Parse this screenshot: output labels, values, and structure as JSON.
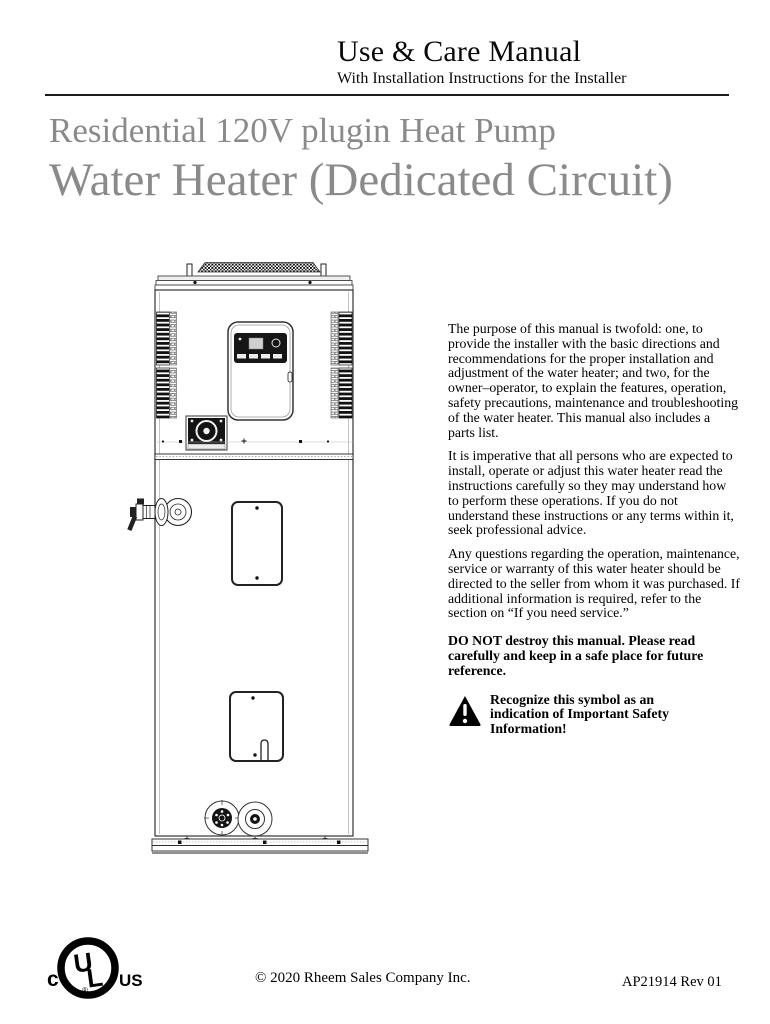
{
  "header": {
    "title": "Use & Care Manual",
    "subtitle": "With Installation Instructions for the Installer"
  },
  "title": {
    "line1": "Residential 120V plugin Heat Pump",
    "line2": "Water Heater (Dedicated Circuit)",
    "color": "#8a8a8a"
  },
  "illustration": {
    "name": "heat-pump-water-heater-front-view-line-drawing"
  },
  "body": {
    "paragraphs": [
      "The purpose of this manual is twofold: one, to provide the installer with the basic directions and recommendations for the proper installation and adjustment of the water heater; and two, for the owner–operator, to explain the features, operation, safety precautions, maintenance and troubleshooting of the water heater. This manual also includes a parts list.",
      "It is imperative that all persons who are expected to install, operate or adjust this water heater read the instructions carefully so they may understand how to perform these operations. If you do not understand these instructions or any terms within it, seek professional advice.",
      "Any questions regarding the operation, maintenance, service or warranty of this water heater should be directed to the seller from whom it was purchased. If additional information is required, refer to the section on “If you need service.”"
    ],
    "bold_notice": "DO NOT destroy this manual. Please read carefully and keep in a safe place for future reference.",
    "safety_note": "Recognize this symbol as an indication of Important Safety Information!"
  },
  "footer": {
    "certification": {
      "left": "c",
      "letter_u": "U",
      "letter_l": "L",
      "right": "US",
      "registered": "®"
    },
    "copyright": "© 2020 Rheem Sales Company Inc.",
    "document_number": "AP21914 Rev 01"
  }
}
